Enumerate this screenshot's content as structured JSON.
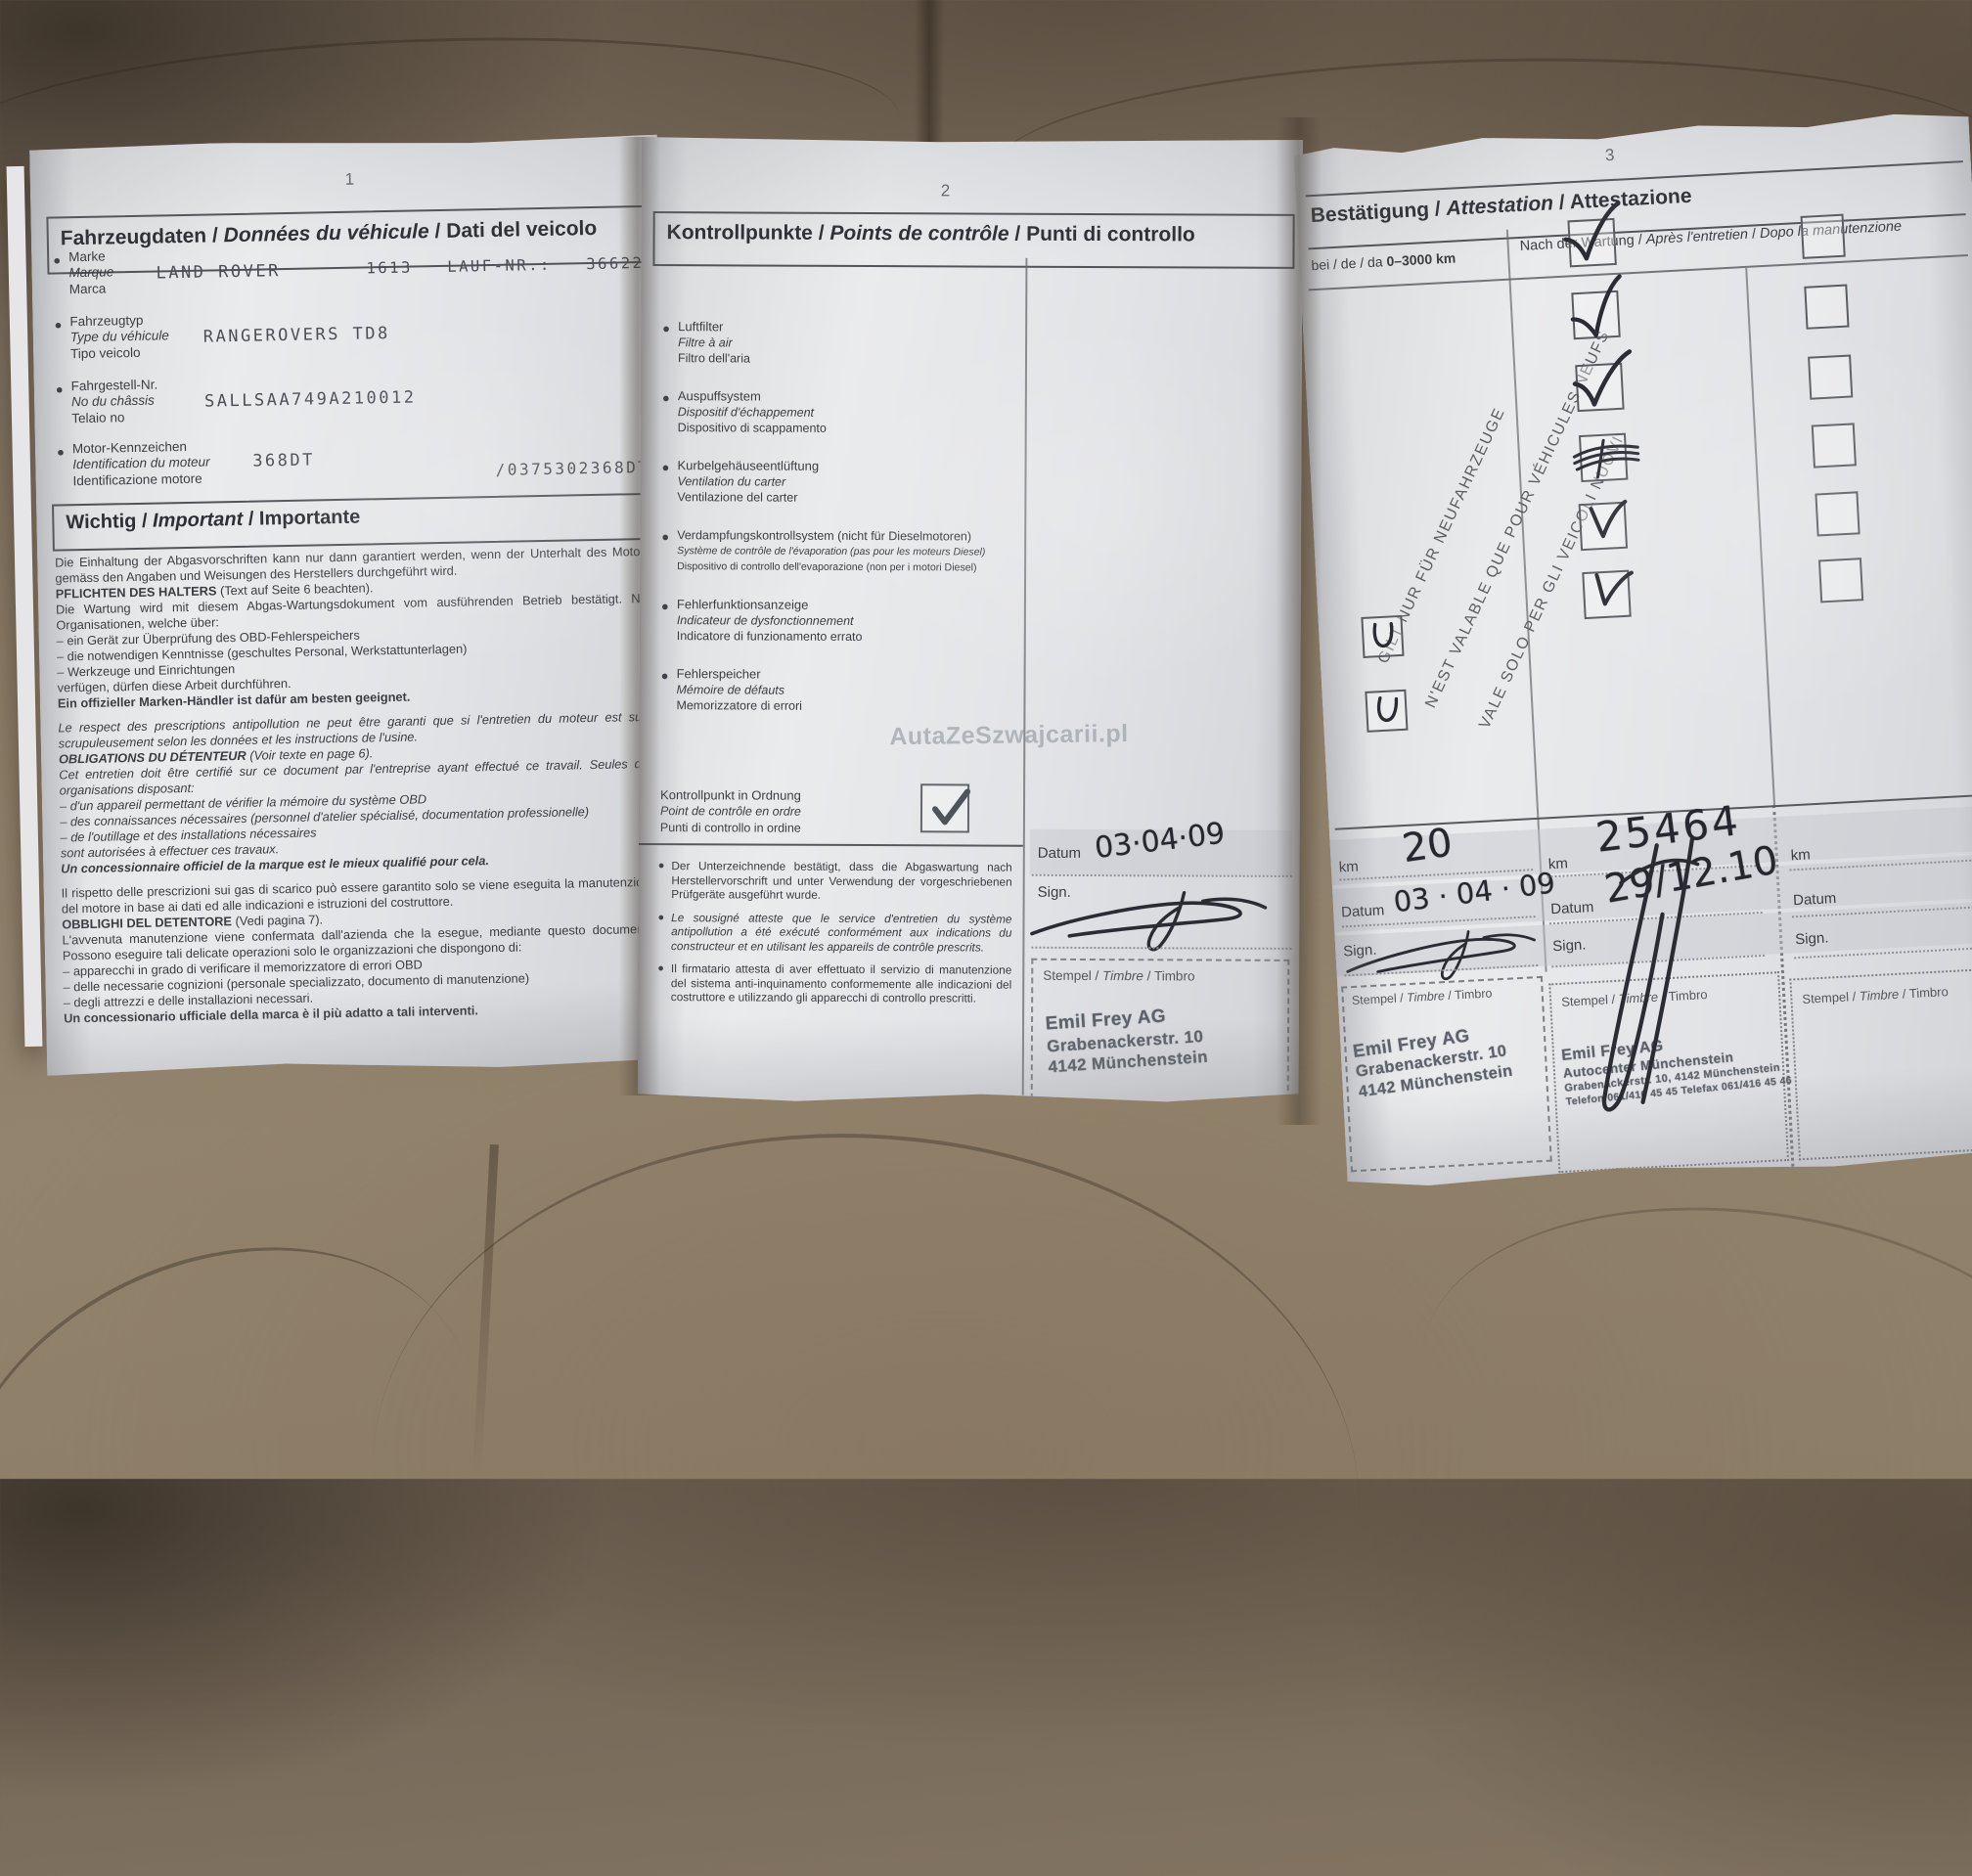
{
  "meta": {
    "sep": " / ",
    "bullet": "●"
  },
  "page1": {
    "num": "1",
    "title": {
      "de": "Fahrzeugdaten",
      "fr": "Données du véhicule",
      "it": "Dati del veicolo"
    },
    "fields": [
      {
        "de": "Marke",
        "fr": "Marque",
        "it": "Marca",
        "value": "LAND ROVER",
        "right": "1613   LAUF-NR.:   36622"
      },
      {
        "de": "Fahrzeugtyp",
        "fr": "Type du véhicule",
        "it": "Tipo veicolo",
        "value": "RANGEROVERS TD8"
      },
      {
        "de": "Fahrgestell-Nr.",
        "fr": "No du châssis",
        "it": "Telaio no",
        "value": "SALLSAA749A210012"
      },
      {
        "de": "Motor-Kennzeichen",
        "fr": "Identification du moteur",
        "it": "Identificazione motore",
        "value": "368DT",
        "right": "/0375302368DT"
      }
    ],
    "important_title": {
      "de": "Wichtig",
      "fr": "Important",
      "it": "Importante"
    },
    "sec_de": {
      "p1": "Die Einhaltung der Abgasvorschriften kann nur dann garantiert werden, wenn der Unterhalt des Motors gemäss den Angaben und Weisungen des Herstellers durchgeführt wird.",
      "lead": "PFLICHTEN DES HALTERS",
      "lead_rest": " (Text auf Seite 6 beachten).",
      "p2": "Die Wartung wird mit diesem Abgas-Wartungsdokument vom ausführenden Betrieb bestätigt. Nur Organisationen, welche über:",
      "b1": "– ein Gerät zur Überprüfung des OBD-Fehlerspeichers",
      "b2": "– die notwendigen Kenntnisse (geschultes Personal, Werkstattunterlagen)",
      "b3": "– Werkzeuge und Einrichtungen",
      "p3": "verfügen, dürfen diese Arbeit durchführen.",
      "p4": "Ein offizieller Marken-Händler ist dafür am besten geeignet."
    },
    "sec_fr": {
      "p1": "Le respect des prescriptions antipollution ne peut être garanti que si l'entretien du moteur est suivi scrupuleusement selon les données et les instructions de l'usine.",
      "lead": "OBLIGATIONS DU DÉTENTEUR",
      "lead_rest": " (Voir texte en page 6).",
      "p2": "Cet entretien doit être certifié sur ce document par l'entreprise ayant effectué ce travail. Seules des organisations disposant:",
      "b1": "– d'un appareil permettant de vérifier la mémoire du système OBD",
      "b2": "– des connaissances nécessaires (personnel d'atelier spécialisé, documentation professionelle)",
      "b3": "– de l'outillage et des installations nécessaires",
      "p3": "sont autorisées à effectuer ces travaux.",
      "p4": "Un concessionnaire officiel de la marque est le mieux qualifié pour cela."
    },
    "sec_it": {
      "p1": "Il rispetto delle prescrizioni sui gas di scarico può essere garantito solo se viene eseguita la manutenzione del motore in base ai dati ed alle indicazioni e istruzioni del costruttore.",
      "lead": "OBBLIGHI DEL DETENTORE",
      "lead_rest": " (Vedi pagina 7).",
      "p2": "L'avvenuta manutenzione viene confermata dall'azienda che la esegue, mediante questo documento. Possono eseguire tali delicate operazioni solo le organizzazioni che dispongono di:",
      "b1": "– apparecchi in grado di verificare il memorizzatore di errori OBD",
      "b2": "– delle necessarie cognizioni (personale specializzato, documento di manutenzione)",
      "b3": "– degli attrezzi e delle installazioni necessari.",
      "p4": "Un concessionario ufficiale della marca è il più adatto a tali interventi."
    }
  },
  "page2": {
    "num": "2",
    "title": {
      "de": "Kontrollpunkte",
      "fr": "Points de contrôle",
      "it": "Punti di controllo"
    },
    "items": [
      {
        "de": "Luftfilter",
        "fr": "Filtre à air",
        "it": "Filtro dell'aria"
      },
      {
        "de": "Auspuffsystem",
        "fr": "Dispositif d'échappement",
        "it": "Dispositivo di scappamento"
      },
      {
        "de": "Kurbelgehäuseentlüftung",
        "fr": "Ventilation du carter",
        "it": "Ventilazione del carter"
      },
      {
        "de": "Verdampfungskontrollsystem (nicht für Dieselmotoren)",
        "fr": "Système de contrôle de l'évaporation (pas pour les moteurs Diesel)",
        "it": "Dispositivo di controllo dell'evaporazione (non per i motori Diesel)"
      },
      {
        "de": "Fehlerfunktionsanzeige",
        "fr": "Indicateur de dysfonctionnement",
        "it": "Indicatore di funzionamento errato"
      },
      {
        "de": "Fehlerspeicher",
        "fr": "Mémoire de défauts",
        "it": "Memorizzatore di errori"
      }
    ],
    "ok": {
      "de": "Kontrollpunkt in Ordnung",
      "fr": "Point de contrôle en ordre",
      "it": "Punti di controllo in ordine"
    },
    "datum_label": "Datum",
    "datum_value": "03·04·09",
    "sign_label": "Sign.",
    "stempel": {
      "de": "Stempel",
      "fr": "Timbre",
      "it": "Timbro"
    },
    "stamp": {
      "l1": "Emil Frey AG",
      "l2": "Grabenackerstr. 10",
      "l3": "4142 Münchenstein"
    },
    "notes": {
      "de": "Der Unterzeichnende bestätigt, dass die Abgaswartung nach Herstellervorschrift und unter Verwendung der vorgeschriebenen Prüfgeräte ausgeführt wurde.",
      "fr": "Le sousigné atteste que le service d'entretien du système antipollution a été exécuté conformément aux indications du constructeur et en utilisant les appareils de contrôle prescrits.",
      "it": "Il firmatario attesta di aver effettuato il servizio di manutenzione del sistema anti-inquinamento conformemente alle indicazioni del costruttore e utilizzando gli apparecchi di controllo prescritti."
    },
    "watermark": "AutaZeSzwajcarii.pl"
  },
  "page3": {
    "num": "3",
    "title": {
      "de": "Bestätigung",
      "fr": "Attestation",
      "it": "Attestazione"
    },
    "col1_header": {
      "prefix": "bei / de / da ",
      "range": "0–3000 km"
    },
    "col2_header": {
      "de": "Nach der Wartung",
      "fr": "Après l'entretien",
      "it": "Dopo la manutenzione"
    },
    "rotated": {
      "de": "GILT NUR FÜR NEUFAHRZEUGE",
      "fr": "N'EST VALABLE QUE POUR VÉHICULES NEUFS",
      "it": "VALE SOLO PER GLI VEICOLI NUOVI"
    },
    "km_label": "km",
    "datum_label": "Datum",
    "sign_label": "Sign.",
    "col1": {
      "km": "20",
      "datum": "03 · 04 · 09"
    },
    "col2": {
      "km": "25464",
      "datum": "29/12.10"
    },
    "stempel": {
      "de": "Stempel",
      "fr": "Timbre",
      "it": "Timbro"
    },
    "stamp1": {
      "l1": "Emil Frey AG",
      "l2": "Grabenackerstr. 10",
      "l3": "4142 Münchenstein"
    },
    "stamp2": {
      "l1": "Emil Frey AG",
      "l2": "Autocenter Münchenstein",
      "l3": "Grabenackerstr. 10, 4142 Münchenstein",
      "l4": "Telefon 061/416 45 45 Telefax 061/416 45 46"
    }
  }
}
